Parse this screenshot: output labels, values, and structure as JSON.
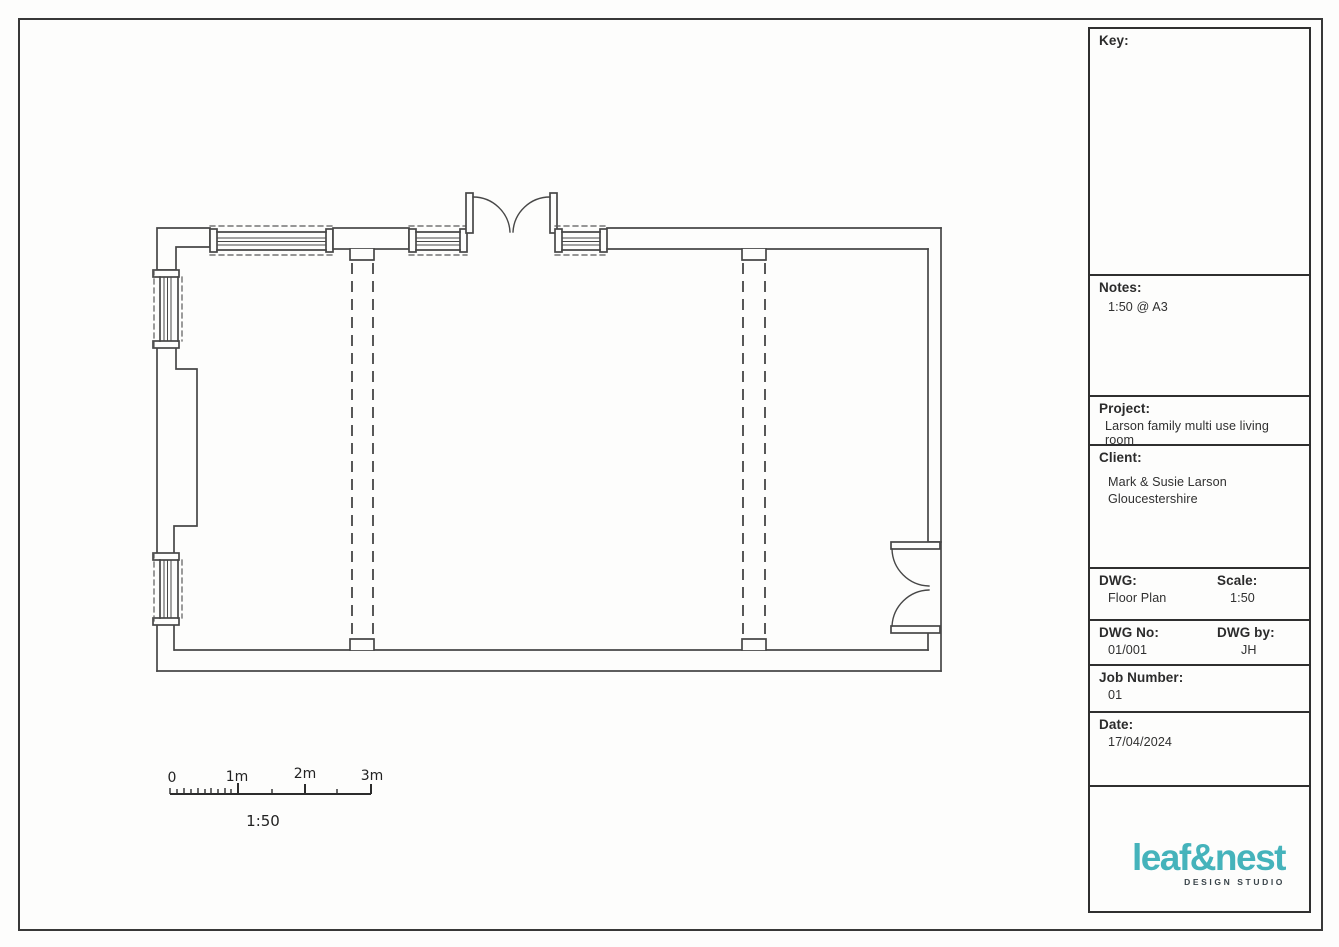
{
  "sheet": {
    "colors": {
      "accent_teal": "#45b3bb",
      "line": "#454545",
      "paper": "#fdfdfc"
    },
    "title_block": {
      "key_label": "Key:",
      "notes_label": "Notes:",
      "notes_value": "1:50 @ A3",
      "project_label": "Project:",
      "project_value": "Larson family multi use living room",
      "client_label": "Client:",
      "client_line1": "Mark & Susie Larson",
      "client_line2": "Gloucestershire",
      "dwg_label": "DWG:",
      "dwg_value": "Floor Plan",
      "scale_label": "Scale:",
      "scale_value": "1:50",
      "dwg_no_label": "DWG No:",
      "dwg_no_value": "01/001",
      "dwg_by_label": "DWG by:",
      "dwg_by_value": "JH",
      "job_label": "Job Number:",
      "job_value": "01",
      "date_label": "Date:",
      "date_value": "17/04/2024"
    },
    "logo": {
      "wordmark": "leaf&nest",
      "tagline": "DESIGN STUDIO"
    },
    "scale_bar": {
      "labels": [
        "0",
        "1m",
        "2m",
        "3m"
      ],
      "ratio_label": "1:50"
    },
    "drawing": {
      "type": "floor-plan",
      "features": [
        "exterior-walls",
        "double-door-top",
        "double-door-right",
        "window-top-left",
        "window-top-mid",
        "window-top-right",
        "window-left-upper",
        "window-left-lower",
        "chimney-breast-left",
        "removed-wall-dashed-pair-1",
        "removed-wall-dashed-pair-2"
      ]
    }
  }
}
